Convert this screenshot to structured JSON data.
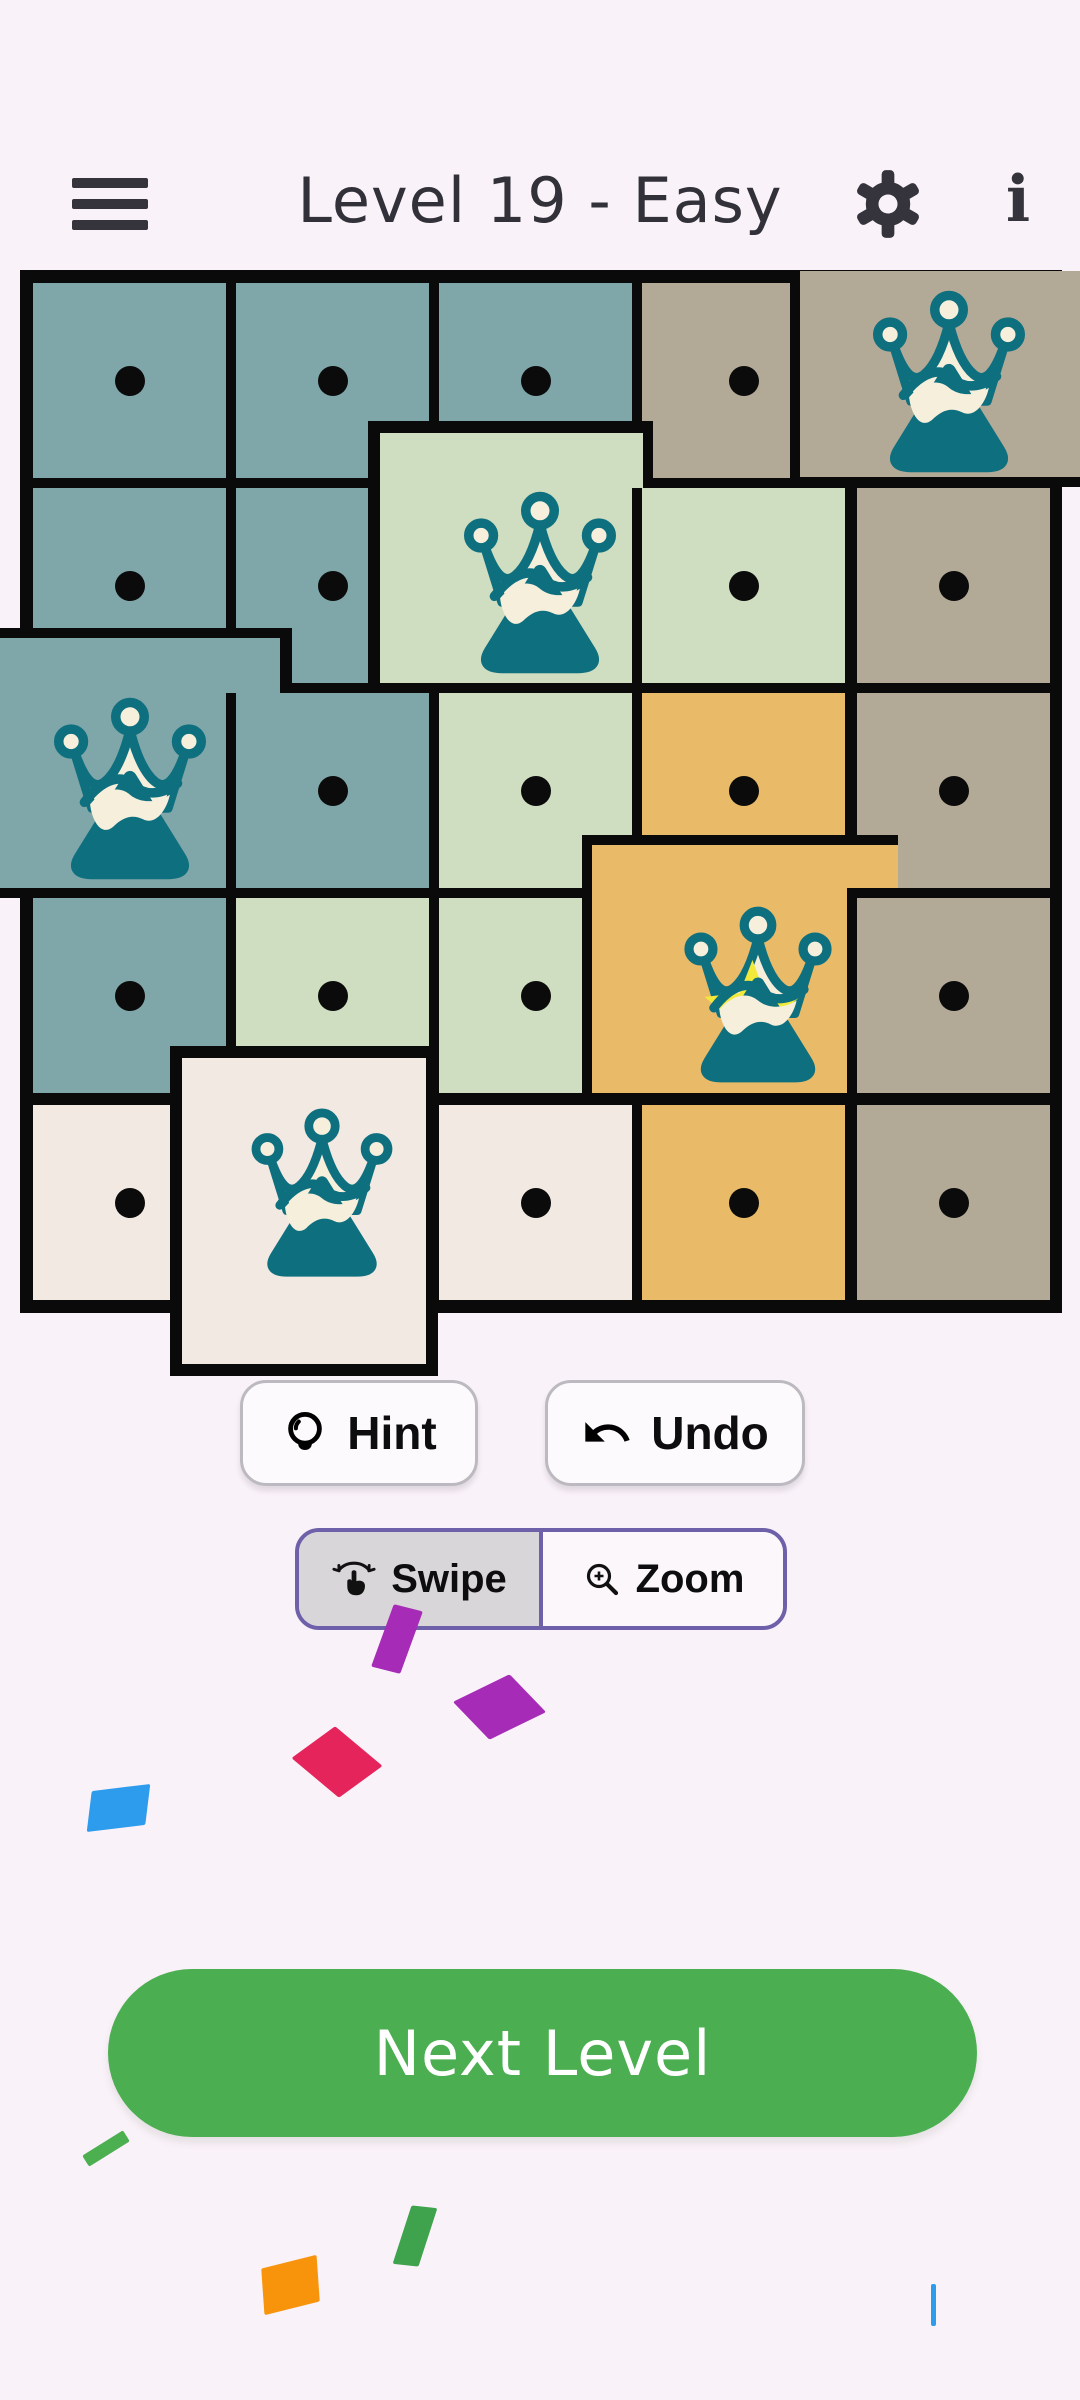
{
  "header": {
    "title": "Level 19 - Easy",
    "menu_icon": "hamburger-icon",
    "settings_icon": "gear-icon",
    "info_icon": "info-icon",
    "info_glyph": "i"
  },
  "palette": {
    "page_bg": "#FAF2F9",
    "board_line": "#0A0A0A",
    "teal": "#7FA6A9",
    "sage": "#CFDDC0",
    "tan": "#B2AA96",
    "orange": "#E9BA68",
    "cream": "#F2E9E2",
    "crown_teal": "#0E6F7E",
    "crown_white": "#F5EFDC",
    "star_yellow": "#F2E93B",
    "icon_dark": "#35343D",
    "title_color": "#32313A",
    "accent_green": "#4BAE50",
    "toggle_purple": "#6E61A9",
    "toggle_selected_bg": "#D9D6D9",
    "toggle_unselected_bg": "#FCF7FB",
    "button_bg": "#FDFAFD",
    "button_border": "#BDB9C0"
  },
  "board": {
    "rows": 5,
    "cols": 5,
    "grid": {
      "colx": [
        33,
        236,
        439,
        642,
        857
      ],
      "colw": [
        193,
        193,
        193,
        203,
        193
      ],
      "rowy": [
        283,
        488,
        693,
        898,
        1105
      ],
      "rowh": [
        195,
        195,
        195,
        195,
        195
      ]
    },
    "cells": [
      {
        "r": 0,
        "c": 0,
        "color": "teal",
        "mark": "dot"
      },
      {
        "r": 0,
        "c": 1,
        "color": "teal",
        "mark": "dot"
      },
      {
        "r": 0,
        "c": 2,
        "color": "teal",
        "mark": "dot"
      },
      {
        "r": 0,
        "c": 3,
        "color": "tan",
        "mark": "dot"
      },
      {
        "r": 0,
        "c": 4,
        "color": "tan",
        "mark": "crown",
        "fill": [
          800,
          271,
          290,
          206
        ],
        "bw": [
          0,
          0,
          10,
          10
        ],
        "icon": {
          "size": 190,
          "dx": 4,
          "dy": 8
        }
      },
      {
        "r": 1,
        "c": 0,
        "color": "teal",
        "mark": "dot"
      },
      {
        "r": 1,
        "c": 1,
        "color": "teal",
        "mark": "dot"
      },
      {
        "r": 1,
        "c": 2,
        "color": "sage",
        "mark": "crown",
        "fill": [
          380,
          433,
          263,
          250
        ],
        "bw": [
          12,
          10,
          10,
          12
        ],
        "icon": {
          "size": 190,
          "dx": 28,
          "dy": 25
        }
      },
      {
        "r": 1,
        "c": 3,
        "color": "sage",
        "mark": "dot",
        "bw": [
          0,
          0,
          0,
          10
        ]
      },
      {
        "r": 1,
        "c": 4,
        "color": "tan",
        "mark": "dot"
      },
      {
        "r": 2,
        "c": 0,
        "color": "teal",
        "mark": "crown",
        "fill": [
          0,
          638,
          280,
          250
        ],
        "bw": [
          10,
          12,
          10,
          0
        ],
        "icon": {
          "size": 190,
          "dx": -10,
          "dy": 26
        }
      },
      {
        "r": 2,
        "c": 1,
        "color": "teal",
        "mark": "dot",
        "bw": [
          0,
          0,
          0,
          10
        ]
      },
      {
        "r": 2,
        "c": 2,
        "color": "sage",
        "mark": "dot"
      },
      {
        "r": 2,
        "c": 3,
        "color": "orange",
        "mark": "dot"
      },
      {
        "r": 2,
        "c": 4,
        "color": "tan",
        "mark": "dot"
      },
      {
        "r": 3,
        "c": 0,
        "color": "teal",
        "mark": "dot"
      },
      {
        "r": 3,
        "c": 1,
        "color": "sage",
        "mark": "dot"
      },
      {
        "r": 3,
        "c": 2,
        "color": "sage",
        "mark": "dot"
      },
      {
        "r": 3,
        "c": 3,
        "color": "orange",
        "mark": "crown_star",
        "fill": [
          592,
          845,
          306,
          248
        ],
        "bw": [
          10,
          0,
          10,
          10
        ],
        "icon": {
          "size": 184,
          "dx": 13,
          "dy": 26
        }
      },
      {
        "r": 3,
        "c": 4,
        "color": "tan",
        "mark": "dot",
        "bw": [
          10,
          0,
          0,
          10
        ]
      },
      {
        "r": 4,
        "c": 0,
        "color": "cream",
        "mark": "dot"
      },
      {
        "r": 4,
        "c": 1,
        "color": "cream",
        "mark": "crown",
        "fill": [
          182,
          1058,
          244,
          306
        ],
        "bw": [
          12,
          12,
          12,
          12
        ],
        "icon": {
          "size": 176,
          "dx": 18,
          "dy": -18
        }
      },
      {
        "r": 4,
        "c": 2,
        "color": "cream",
        "mark": "dot"
      },
      {
        "r": 4,
        "c": 3,
        "color": "orange",
        "mark": "dot"
      },
      {
        "r": 4,
        "c": 4,
        "color": "tan",
        "mark": "dot"
      }
    ]
  },
  "controls": {
    "hint_label": "Hint",
    "undo_label": "Undo",
    "swipe_label": "Swipe",
    "zoom_label": "Zoom",
    "swipe_selected": true,
    "next_level_label": "Next Level"
  },
  "confetti": [
    {
      "x": 382,
      "y": 1606,
      "w": 30,
      "h": 66,
      "rot": 14,
      "skx": -6,
      "color": "#A62CB8"
    },
    {
      "x": 468,
      "y": 1682,
      "w": 63,
      "h": 50,
      "rot": -26,
      "skx": 18,
      "color": "#A62CB8"
    },
    {
      "x": 310,
      "y": 1732,
      "w": 54,
      "h": 60,
      "rot": -36,
      "skx": 14,
      "color": "#E6245C"
    },
    {
      "x": 89,
      "y": 1788,
      "w": 59,
      "h": 40,
      "rot": -7,
      "skx": -14,
      "color": "#2D9CEC"
    },
    {
      "x": 82,
      "y": 2142,
      "w": 48,
      "h": 13,
      "rot": -32,
      "skx": 0,
      "color": "#4CAF50"
    },
    {
      "x": 402,
      "y": 2206,
      "w": 26,
      "h": 60,
      "rot": 6,
      "skx": -12,
      "color": "#3FA34D"
    },
    {
      "x": 262,
      "y": 2262,
      "w": 57,
      "h": 46,
      "rot": -14,
      "skx": -10,
      "color": "#F7940C"
    },
    {
      "x": 931,
      "y": 2284,
      "w": 5,
      "h": 42,
      "rot": 0,
      "skx": 0,
      "color": "#2D9CEC"
    }
  ]
}
